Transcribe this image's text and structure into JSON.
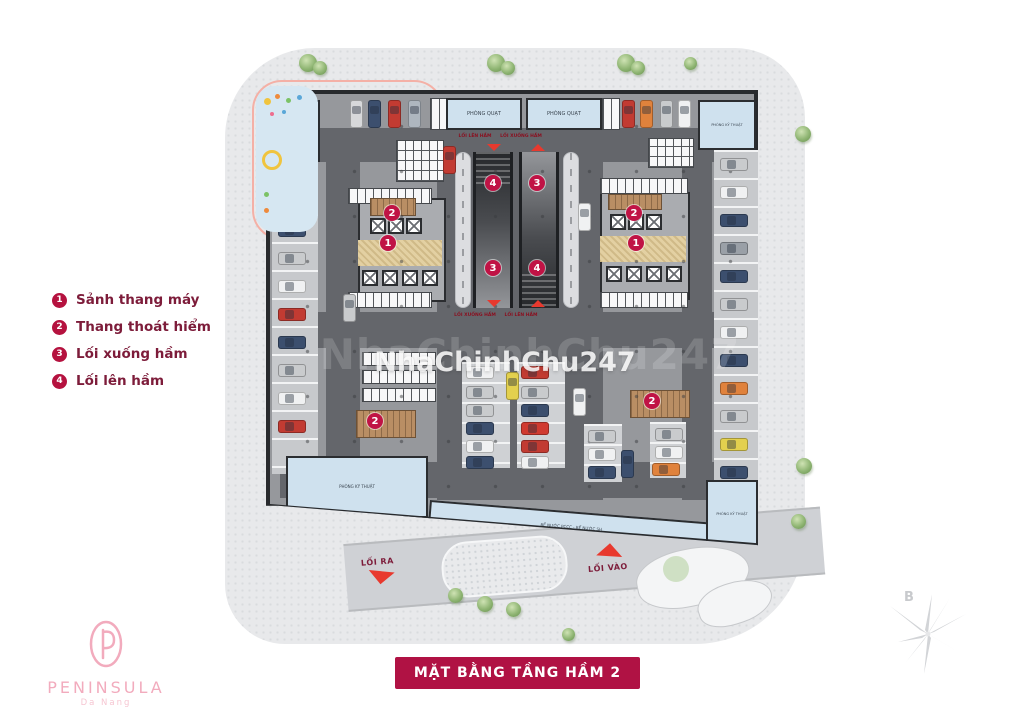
{
  "banner": {
    "title": "MẶT BẰNG TẦNG HẦM 2",
    "bg": "#b01244"
  },
  "legend": {
    "items": [
      {
        "num": "1",
        "label": "Sảnh thang máy"
      },
      {
        "num": "2",
        "label": "Thang thoát hiểm"
      },
      {
        "num": "3",
        "label": "Lối xuống hầm"
      },
      {
        "num": "4",
        "label": "Lối lên hầm"
      }
    ],
    "accent": "#b5123f"
  },
  "watermark": {
    "text": "NhaChinhChu247"
  },
  "logo": {
    "name": "PENINSULA",
    "subtitle": "Da Nang",
    "color": "#f2abbd"
  },
  "compass": {
    "north_label": "B"
  },
  "drive": {
    "exit_label": "LỐI RA",
    "entry_label": "LỐI VÀO"
  },
  "plan": {
    "rooms": [
      {
        "label": "PHÒNG KỸ THUẬT",
        "x": 6,
        "y": 6,
        "w": 44,
        "h": 62,
        "fs": 3.5
      },
      {
        "label": "PHÒNG QUẠT",
        "x": 176,
        "y": 4,
        "w": 76,
        "h": 32,
        "fs": 5
      },
      {
        "label": "PHÒNG QUẠT",
        "x": 256,
        "y": 4,
        "w": 76,
        "h": 32,
        "fs": 5
      },
      {
        "label": "PHÒNG KỸ THUẬT",
        "x": 428,
        "y": 6,
        "w": 58,
        "h": 50,
        "fs": 3.5
      },
      {
        "label": "PHÒNG KỸ THUẬT",
        "x": 16,
        "y": 362,
        "w": 142,
        "h": 62,
        "fs": 4
      },
      {
        "label": "BỂ NƯỚC PCCC - BỂ NƯỚC SH",
        "x": 160,
        "y": 406,
        "w": 286,
        "h": 32,
        "fs": 4,
        "rot": 4.6
      },
      {
        "label": "PHÒNG KỸ THUẬT",
        "x": 436,
        "y": 386,
        "w": 52,
        "h": 68,
        "fs": 3.5
      }
    ],
    "markers": [
      {
        "num": "2",
        "x": 114,
        "y": 111
      },
      {
        "num": "1",
        "x": 110,
        "y": 141
      },
      {
        "num": "2",
        "x": 356,
        "y": 111
      },
      {
        "num": "1",
        "x": 358,
        "y": 141
      },
      {
        "num": "4",
        "x": 215,
        "y": 81
      },
      {
        "num": "3",
        "x": 259,
        "y": 81
      },
      {
        "num": "3",
        "x": 215,
        "y": 166
      },
      {
        "num": "4",
        "x": 259,
        "y": 166
      },
      {
        "num": "2",
        "x": 97,
        "y": 319
      },
      {
        "num": "2",
        "x": 374,
        "y": 299
      }
    ],
    "ramp_labels": [
      {
        "text": "LỐI LÊN HẦM",
        "x": 195,
        "y": 40
      },
      {
        "text": "LỐI XUỐNG HẦM",
        "x": 241,
        "y": 40
      },
      {
        "text": "LỐI XUỐNG HẦM",
        "x": 195,
        "y": 219
      },
      {
        "text": "LỐI LÊN HẦM",
        "x": 241,
        "y": 219
      }
    ],
    "cars": [
      {
        "x": 80,
        "y": 6,
        "o": "v",
        "c": "#d7d8da"
      },
      {
        "x": 98,
        "y": 6,
        "o": "v",
        "c": "#3c4f6e"
      },
      {
        "x": 118,
        "y": 6,
        "o": "v",
        "c": "#c23b32"
      },
      {
        "x": 138,
        "y": 6,
        "o": "v",
        "c": "#aeb6bf"
      },
      {
        "x": 352,
        "y": 6,
        "o": "v",
        "c": "#c23b32"
      },
      {
        "x": 370,
        "y": 6,
        "o": "v",
        "c": "#e0823c"
      },
      {
        "x": 390,
        "y": 6,
        "o": "v",
        "c": "#c9cbcd"
      },
      {
        "x": 408,
        "y": 6,
        "o": "v",
        "c": "#f0f1f2"
      },
      {
        "x": 173,
        "y": 52,
        "o": "v",
        "c": "#c23b32"
      },
      {
        "x": 8,
        "y": 74,
        "o": "h",
        "c": "#c9cbcd"
      },
      {
        "x": 8,
        "y": 102,
        "o": "h",
        "c": "#c23b32"
      },
      {
        "x": 8,
        "y": 130,
        "o": "h",
        "c": "#3c4f6e"
      },
      {
        "x": 8,
        "y": 158,
        "o": "h",
        "c": "#c9cbcd"
      },
      {
        "x": 8,
        "y": 186,
        "o": "h",
        "c": "#f0f1f2"
      },
      {
        "x": 8,
        "y": 214,
        "o": "h",
        "c": "#c23b32"
      },
      {
        "x": 8,
        "y": 242,
        "o": "h",
        "c": "#3c4f6e"
      },
      {
        "x": 8,
        "y": 270,
        "o": "h",
        "c": "#c9cbcd"
      },
      {
        "x": 8,
        "y": 298,
        "o": "h",
        "c": "#f0f1f2"
      },
      {
        "x": 8,
        "y": 326,
        "o": "h",
        "c": "#c23b32"
      },
      {
        "x": 450,
        "y": 64,
        "o": "h",
        "c": "#c9cbcd"
      },
      {
        "x": 450,
        "y": 92,
        "o": "h",
        "c": "#f0f1f2"
      },
      {
        "x": 450,
        "y": 120,
        "o": "h",
        "c": "#3c4f6e"
      },
      {
        "x": 450,
        "y": 148,
        "o": "h",
        "c": "#9aa0a7"
      },
      {
        "x": 450,
        "y": 176,
        "o": "h",
        "c": "#3c4f6e"
      },
      {
        "x": 450,
        "y": 204,
        "o": "h",
        "c": "#c9cbcd"
      },
      {
        "x": 450,
        "y": 232,
        "o": "h",
        "c": "#f0f1f2"
      },
      {
        "x": 450,
        "y": 260,
        "o": "h",
        "c": "#3c4f6e"
      },
      {
        "x": 450,
        "y": 288,
        "o": "h",
        "c": "#e0823c"
      },
      {
        "x": 450,
        "y": 316,
        "o": "h",
        "c": "#c9cbcd"
      },
      {
        "x": 450,
        "y": 344,
        "o": "h",
        "c": "#e3d04e"
      },
      {
        "x": 450,
        "y": 372,
        "o": "h",
        "c": "#3c4f6e"
      },
      {
        "x": 73,
        "y": 200,
        "o": "v",
        "c": "#c9cbcd"
      },
      {
        "x": 196,
        "y": 272,
        "o": "h",
        "c": "#f0f1f2"
      },
      {
        "x": 196,
        "y": 292,
        "o": "h",
        "c": "#c9cbcd"
      },
      {
        "x": 196,
        "y": 310,
        "o": "h",
        "c": "#c9cbcd"
      },
      {
        "x": 196,
        "y": 328,
        "o": "h",
        "c": "#3c4f6e"
      },
      {
        "x": 196,
        "y": 346,
        "o": "h",
        "c": "#f0f1f2"
      },
      {
        "x": 196,
        "y": 362,
        "o": "h",
        "c": "#3c4f6e"
      },
      {
        "x": 251,
        "y": 272,
        "o": "h",
        "c": "#c23b32"
      },
      {
        "x": 251,
        "y": 292,
        "o": "h",
        "c": "#c9cbcd"
      },
      {
        "x": 251,
        "y": 310,
        "o": "h",
        "c": "#3c4f6e"
      },
      {
        "x": 251,
        "y": 328,
        "o": "h",
        "c": "#d03a30"
      },
      {
        "x": 251,
        "y": 346,
        "o": "h",
        "c": "#c23b32"
      },
      {
        "x": 251,
        "y": 362,
        "o": "h",
        "c": "#f0f1f2"
      },
      {
        "x": 236,
        "y": 278,
        "o": "v",
        "c": "#e3d04e"
      },
      {
        "x": 303,
        "y": 294,
        "o": "v",
        "c": "#f0f1f2"
      },
      {
        "x": 308,
        "y": 109,
        "o": "v",
        "c": "#f0f1f2"
      },
      {
        "x": 318,
        "y": 336,
        "o": "h",
        "c": "#c9cbcd"
      },
      {
        "x": 318,
        "y": 354,
        "o": "h",
        "c": "#f0f1f2"
      },
      {
        "x": 318,
        "y": 372,
        "o": "h",
        "c": "#3c4f6e"
      },
      {
        "x": 385,
        "y": 334,
        "o": "h",
        "c": "#c9cbcd"
      },
      {
        "x": 385,
        "y": 352,
        "o": "h",
        "c": "#f0f1f2"
      },
      {
        "x": 382,
        "y": 369,
        "o": "h",
        "c": "#e0823c"
      },
      {
        "x": 351,
        "y": 356,
        "o": "v",
        "c": "#3c4f6e"
      }
    ],
    "trees": [
      [
        299,
        54,
        18
      ],
      [
        313,
        61,
        14
      ],
      [
        487,
        54,
        18
      ],
      [
        501,
        61,
        14
      ],
      [
        617,
        54,
        18
      ],
      [
        631,
        61,
        14
      ],
      [
        684,
        57,
        13
      ],
      [
        795,
        126,
        16
      ],
      [
        796,
        458,
        16
      ],
      [
        791,
        514,
        15
      ],
      [
        448,
        588,
        15
      ],
      [
        477,
        596,
        16
      ],
      [
        506,
        602,
        15
      ],
      [
        562,
        628,
        13
      ]
    ],
    "playground_dots": [
      [
        264,
        98,
        7,
        "#f0c43e"
      ],
      [
        275,
        94,
        5,
        "#ee8a3c"
      ],
      [
        286,
        98,
        5,
        "#7cc266"
      ],
      [
        297,
        95,
        5,
        "#5aa7d8"
      ],
      [
        270,
        112,
        4,
        "#ee6e8e"
      ],
      [
        282,
        110,
        4,
        "#5aa7d8"
      ],
      [
        262,
        150,
        14,
        "#f0c43e"
      ],
      [
        264,
        192,
        5,
        "#7cc266"
      ],
      [
        264,
        208,
        5,
        "#ee8a3c"
      ]
    ]
  }
}
